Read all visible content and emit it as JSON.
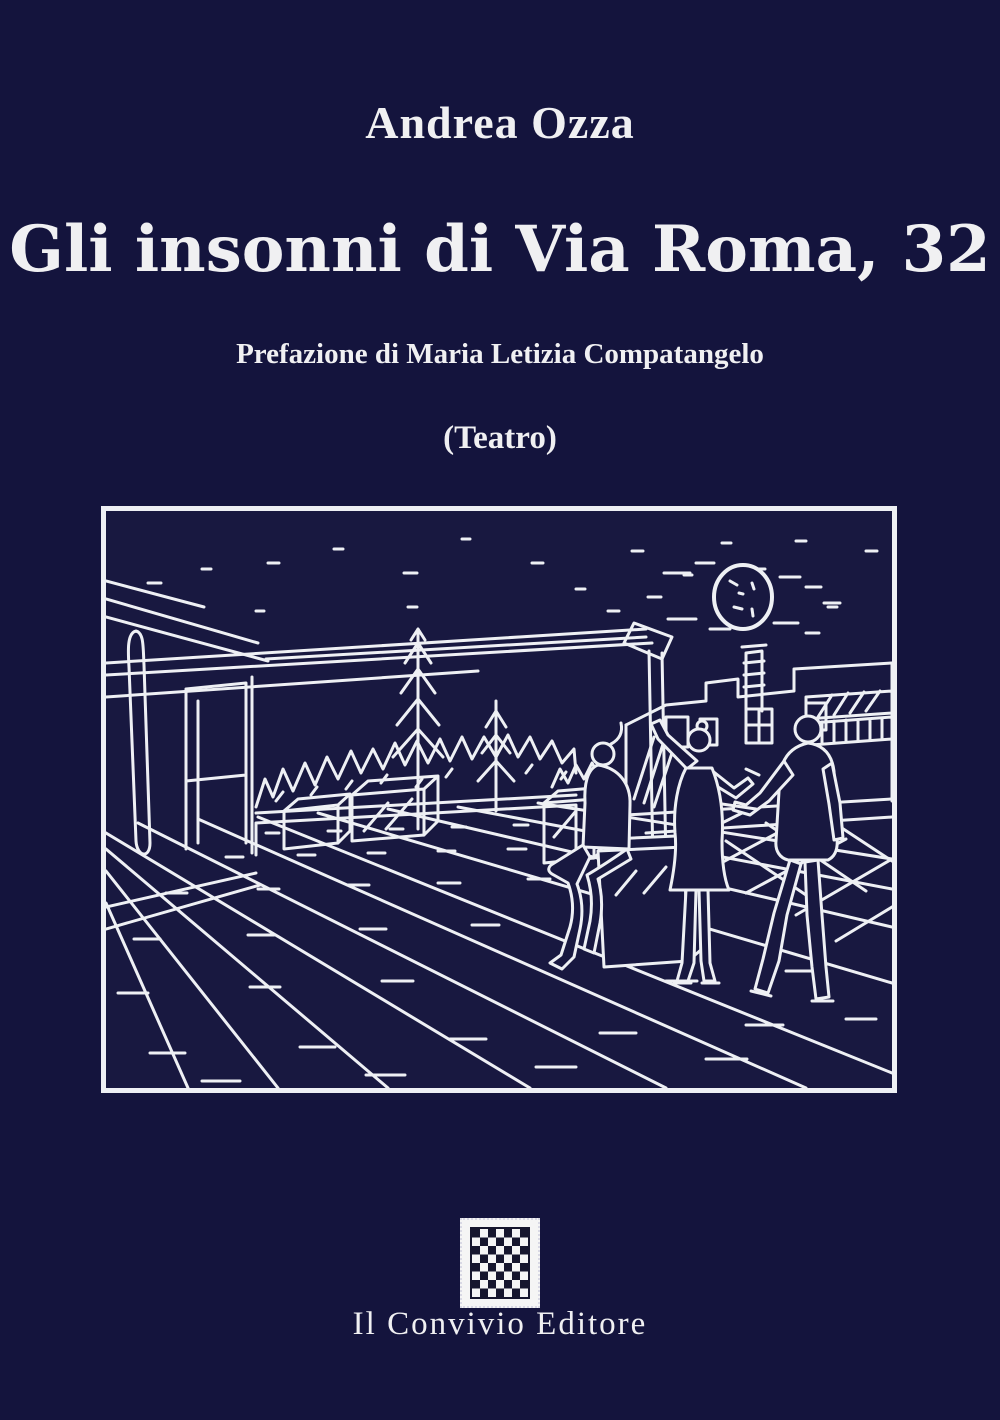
{
  "cover": {
    "author": "Andrea Ozza",
    "title": "Gli insonni di Via Roma, 32",
    "preface": "Prefazione di Maria Letizia Compatangelo",
    "genre": "(Teatro)",
    "publisher": "Il Convivio Editore"
  },
  "illustration": {
    "alt": "White ink line drawing of a rooftop terrace at night: starry sky with full moon, pergola beams, trees behind a parapet, planter boxes, buildings at right, a woman seated on a cube with crossed legs and a standing woman and man seen from behind, on a tiled floor drawn in perspective"
  },
  "logo": {
    "name": "checkerboard-stamp"
  },
  "colors": {
    "background": "#14143d",
    "illustration_background": "#181840",
    "line": "#eef0f4",
    "text": "#f0f0f2",
    "stamp_light": "#f5f5f5",
    "stamp_dark": "#16162e"
  }
}
